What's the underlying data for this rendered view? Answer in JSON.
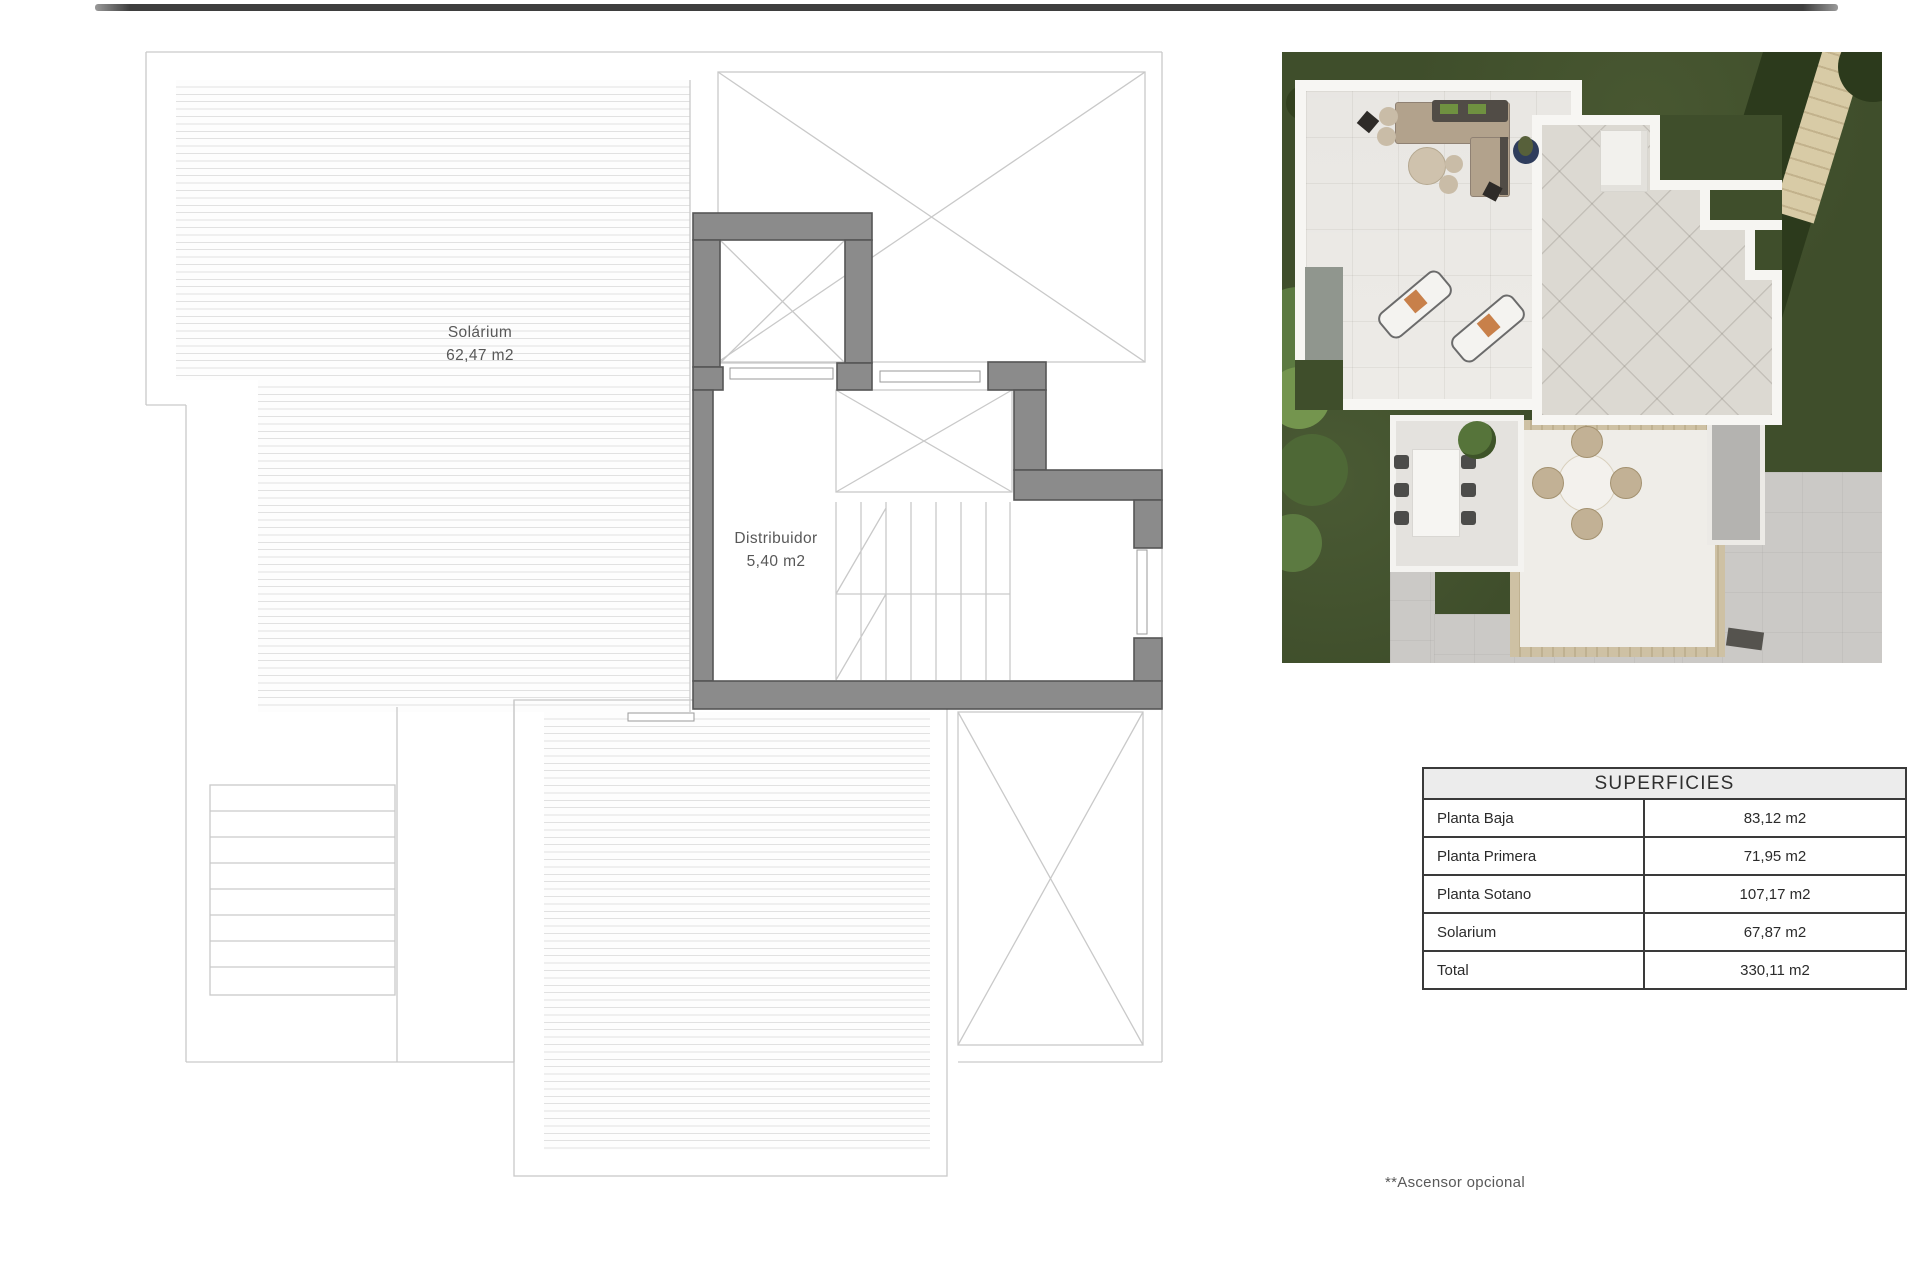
{
  "floor_plan": {
    "labels": [
      {
        "name": "Solárium",
        "area": "62,47 m2"
      },
      {
        "name": "Distribuidor",
        "area": "5,40 m2"
      }
    ]
  },
  "superficies_table": {
    "title": "SUPERFICIES",
    "rows": [
      {
        "label": "Planta Baja",
        "value": "83,12 m2"
      },
      {
        "label": "Planta Primera",
        "value": "71,95 m2"
      },
      {
        "label": "Planta Sotano",
        "value": "107,17 m2"
      },
      {
        "label": "Solarium",
        "value": "67,87 m2"
      },
      {
        "label": "Total",
        "value": "330,11 m2"
      }
    ]
  },
  "footnote": "**Ascensor opcional",
  "colors": {
    "wall_gray": "#8b8b8b",
    "plan_line": "#c9c9c9",
    "deck_stripe": "#e1e1e1",
    "table_border": "#3a3a3a",
    "table_header_bg": "#ececec",
    "grass_green": "#3f4e2b",
    "stone_beige": "#cec1a4",
    "top_bar": "#3e3e3e"
  }
}
